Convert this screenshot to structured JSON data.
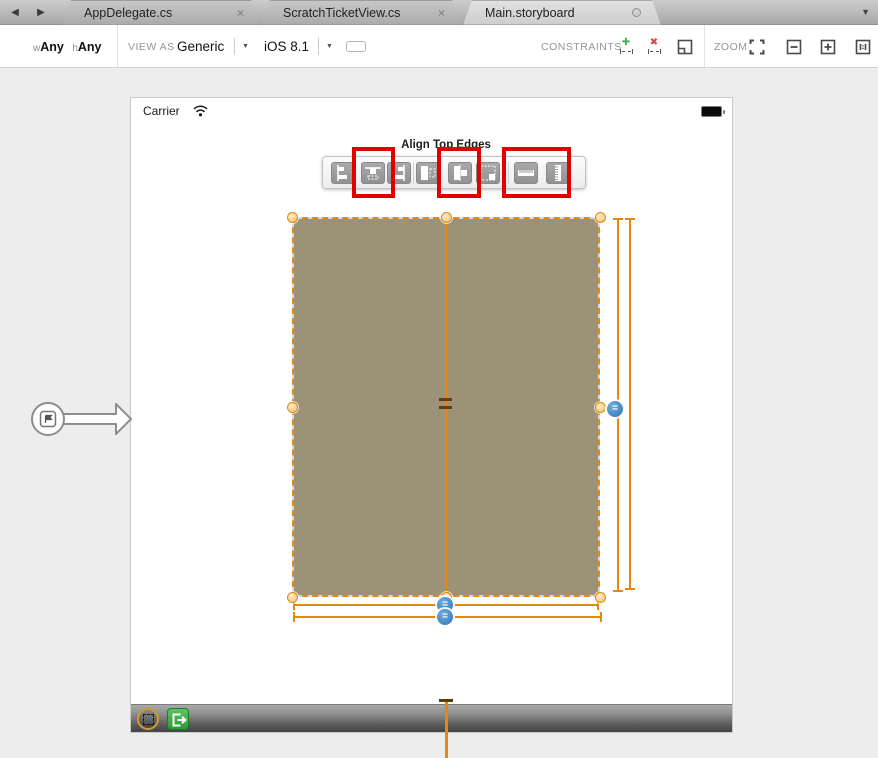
{
  "tab_bar": {
    "back_glyph": "◀",
    "forward_glyph": "▶",
    "overflow_glyph": "▼",
    "tabs": [
      {
        "label": "AppDelegate.cs",
        "close_glyph": "×"
      },
      {
        "label": "ScratchTicketView.cs",
        "close_glyph": "×"
      },
      {
        "label": "Main.storyboard"
      }
    ]
  },
  "toolbar": {
    "size_class": {
      "width_prefix": "w",
      "width_value": "Any",
      "height_prefix": "h",
      "height_value": "Any"
    },
    "view_as_label": "VIEW AS",
    "device": "Generic",
    "device_dropdown_glyph": "▼",
    "os_version": "iOS 8.1",
    "os_dropdown_glyph": "▼",
    "constraints_label": "CONSTRAINTS",
    "add_constraint_glyph": "✚",
    "remove_constraint_glyph": "✖",
    "zoom_label": "ZOOM"
  },
  "designer": {
    "status_carrier": "Carrier",
    "tooltip": "Align Top Edges",
    "constraint_badge_glyph": "=",
    "align_buttons": [
      "align-left-edges",
      "align-top-edges",
      "align-right-edges",
      "align-leading-in-container",
      "align-center-in-container",
      "align-trailing-in-container",
      "pin-width",
      "pin-height"
    ]
  },
  "colors": {
    "selection_accent": "#e8870f",
    "highlight_red": "#e00000",
    "constraint_badge_blue": "#2e76b5",
    "view_fill": "#9c9278",
    "segue_green": "#3fae49",
    "add_green": "#4caf50",
    "remove_red": "#cc4b45"
  }
}
